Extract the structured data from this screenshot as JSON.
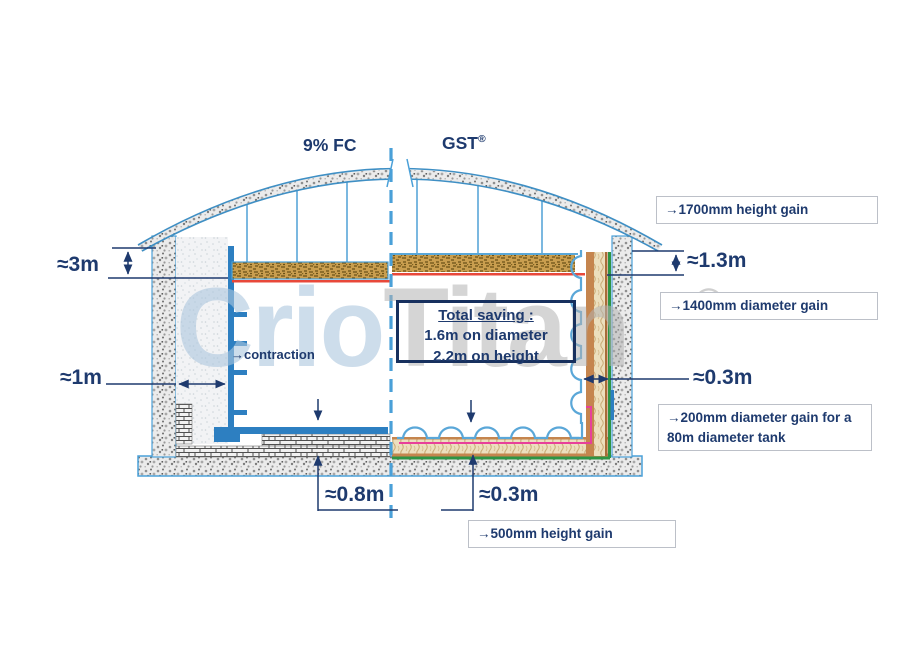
{
  "headers": {
    "left": "9% FC",
    "right": "GST",
    "right_reg": "®"
  },
  "watermark": {
    "part1": "Crio",
    "part2": "Titan",
    "reg": "®"
  },
  "dimensions": {
    "left_wall_annulus_height": "≈3m",
    "left_wall_annulus_width": "≈1m",
    "right_wall_annulus_height": "≈1.3m",
    "right_wall_annulus_width": "≈0.3m",
    "left_floor_thickness": "≈0.8m",
    "right_floor_thickness": "≈0.3m"
  },
  "contraction_label": "→contraction",
  "total_saving": {
    "title": "Total saving :",
    "line1": "1.6m on diameter",
    "line2": "2.2m on height"
  },
  "callouts": [
    {
      "text": "→1700mm height gain"
    },
    {
      "text": "→1400mm diameter gain"
    },
    {
      "text": "→200mm diameter gain for a 80m diameter tank"
    },
    {
      "text": "→500mm height gain"
    }
  ],
  "colors": {
    "annotation_navy": "#1e3a6e",
    "liner_blue": "#2d7fc1",
    "membrane_light_blue": "#5aa7d8",
    "deck_tan": "#c99e4f",
    "red_line": "#e8483a",
    "green_line": "#2e9444",
    "pink_line": "#e8409a",
    "insulation_brown": "#c5854e",
    "callout_border": "#bcc0c8"
  }
}
